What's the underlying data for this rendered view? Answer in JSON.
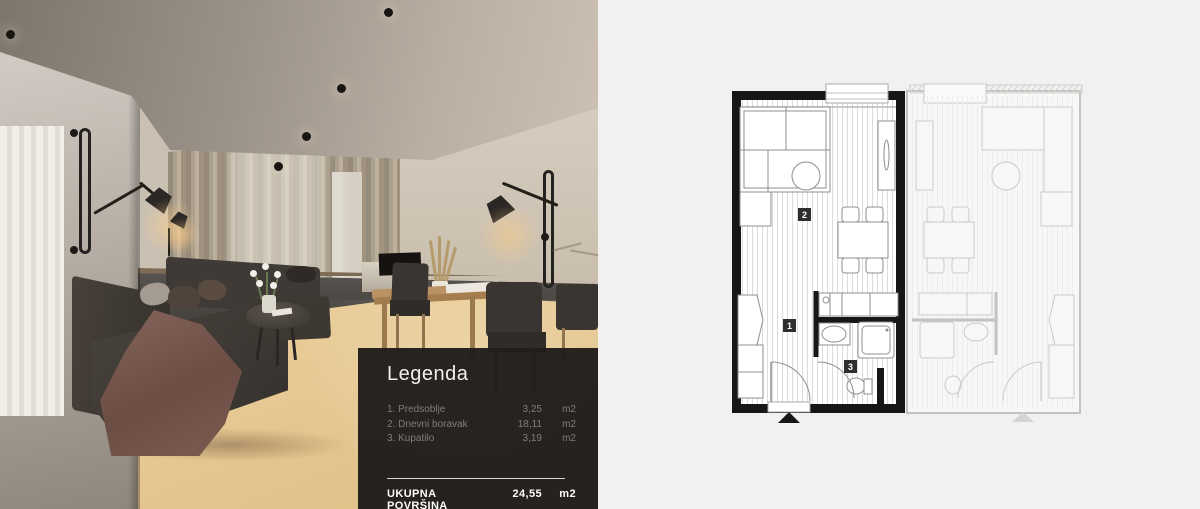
{
  "legend": {
    "title": "Legenda",
    "items": [
      {
        "label": "1. Predsoblje",
        "area": "3,25",
        "unit": "m2"
      },
      {
        "label": "2. Dnevni boravak",
        "area": "18,11",
        "unit": "m2"
      },
      {
        "label": "3. Kupatilo",
        "area": "3,19",
        "unit": "m2"
      }
    ],
    "total_label": "UKUPNA POVRŠINA",
    "total_area": "24,55",
    "total_unit": "m2"
  },
  "plan": {
    "room_labels": {
      "hall": "1",
      "living": "2",
      "bath": "3"
    }
  },
  "branding": {
    "name_line1": "HEROLDO",
    "name_line2": "NEKRETNINE",
    "website": "www.heroldo.com",
    "watermark_line1": "BUL",
    "watermark_line2": "RLK"
  },
  "colors": {
    "brand_blue": "#8ea9bd",
    "icon_blue": "#5b93b4",
    "navy": "#22313f",
    "panel_bg": "#201d1a",
    "plan_wall": "#161616",
    "background": "#f2f1ef"
  }
}
